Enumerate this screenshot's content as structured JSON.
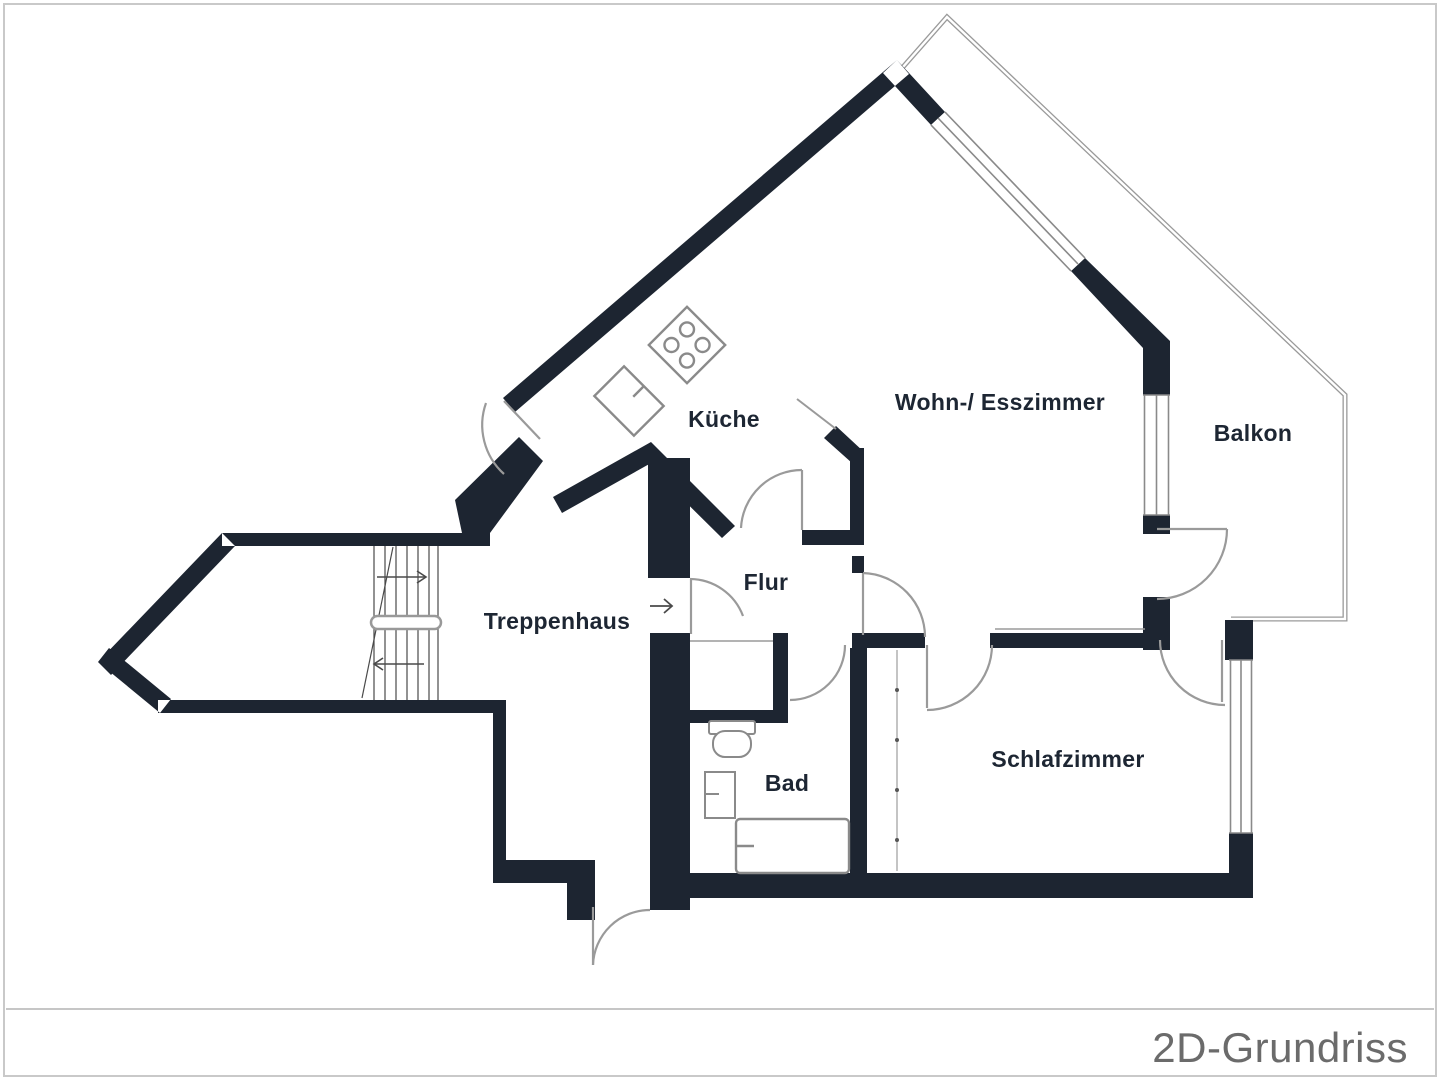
{
  "plan": {
    "type": "floorplan-2d",
    "rooms": [
      {
        "id": "kueche",
        "label": "Küche"
      },
      {
        "id": "wohn-esszimmer",
        "label": "Wohn-/ Esszimmer"
      },
      {
        "id": "balkon",
        "label": "Balkon"
      },
      {
        "id": "flur",
        "label": "Flur"
      },
      {
        "id": "treppenhaus",
        "label": "Treppenhaus"
      },
      {
        "id": "bad",
        "label": "Bad"
      },
      {
        "id": "schlafzimmer",
        "label": "Schlafzimmer"
      }
    ],
    "fixtures": [
      "stove",
      "kitchen-sink",
      "toilet",
      "washbasin",
      "bathtub",
      "stairs"
    ],
    "colors": {
      "wall": "#1d2531",
      "label_text": "#1d2633",
      "door_line": "#9a9a9a",
      "window_line": "#8a8a8a",
      "railing_line": "#9a9a9a",
      "stair_line": "#4a4a4a",
      "frame_border": "#c9c9c9",
      "background": "#ffffff",
      "footer_text": "#6b6b6b"
    }
  },
  "footer": {
    "title": "2D-Grundriss"
  }
}
